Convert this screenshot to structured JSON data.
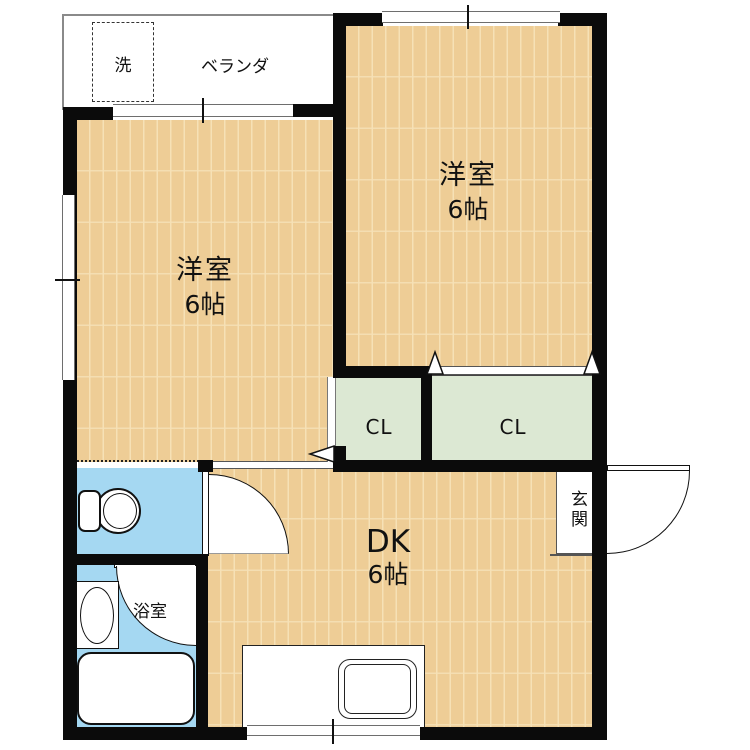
{
  "plan": {
    "type": "japanese-apartment-floor-plan",
    "rooms": {
      "balcony": {
        "label": "ベランダ"
      },
      "laundry": {
        "label": "洗"
      },
      "bedroom_left": {
        "name": "洋室",
        "size": "6帖"
      },
      "bedroom_right": {
        "name": "洋室",
        "size": "6帖"
      },
      "dining_kitchen": {
        "name": "DK",
        "size": "6帖"
      },
      "closet_left": {
        "label": "CL"
      },
      "closet_right": {
        "label": "CL"
      },
      "bathroom": {
        "label": "浴室"
      },
      "entrance": {
        "label": "玄関"
      }
    },
    "colors": {
      "wood_floor": "#EECD96",
      "wood_plank_line": "#F6E1B6",
      "closet_fill": "#DCE8D3",
      "water_area_fill": "#A5D8F2",
      "wall": "#0b0b0b",
      "background": "#ffffff"
    }
  }
}
